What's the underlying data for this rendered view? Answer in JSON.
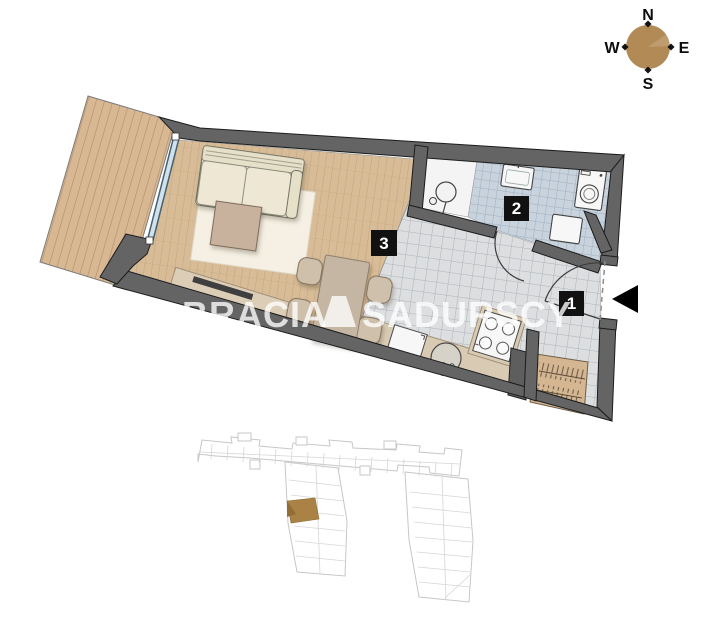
{
  "compass": {
    "north": "N",
    "east": "E",
    "south": "S",
    "west": "W"
  },
  "watermark": {
    "part1": "BRACIA",
    "part2": "SADURSCY"
  },
  "room_labels": [
    {
      "number": "1"
    },
    {
      "number": "2"
    },
    {
      "number": "3"
    }
  ],
  "icons": {
    "entrance_arrow": "entrance-direction-arrow",
    "compass_rose": "compass-rose"
  },
  "colors": {
    "wall": "#646464",
    "wall_outline": "#1c1c1c",
    "balcony_deck": "#d8b893",
    "balcony_line": "#b08d65",
    "wood_floor": "#d7bc97",
    "wood_line": "#c0a47c",
    "tile_floor": "#dcdee0",
    "tile_line": "#aeb3b9",
    "bath_tile": "#c9d3dd",
    "bath_tile_line": "#9aabbd",
    "fixture_white": "#f7f7f7",
    "counter": "#d9cbb3",
    "wardrobe": "#d4b792",
    "sofa": "#ede7d4",
    "rug": "#f5f0e3",
    "coffee_table": "#c8b19d",
    "compass_circle": "#b28a55",
    "site_plan_line": "#c7c7c7",
    "site_highlight": "#ab8245",
    "label_bg": "#111111",
    "label_text": "#ffffff",
    "arrow": "#000000"
  }
}
